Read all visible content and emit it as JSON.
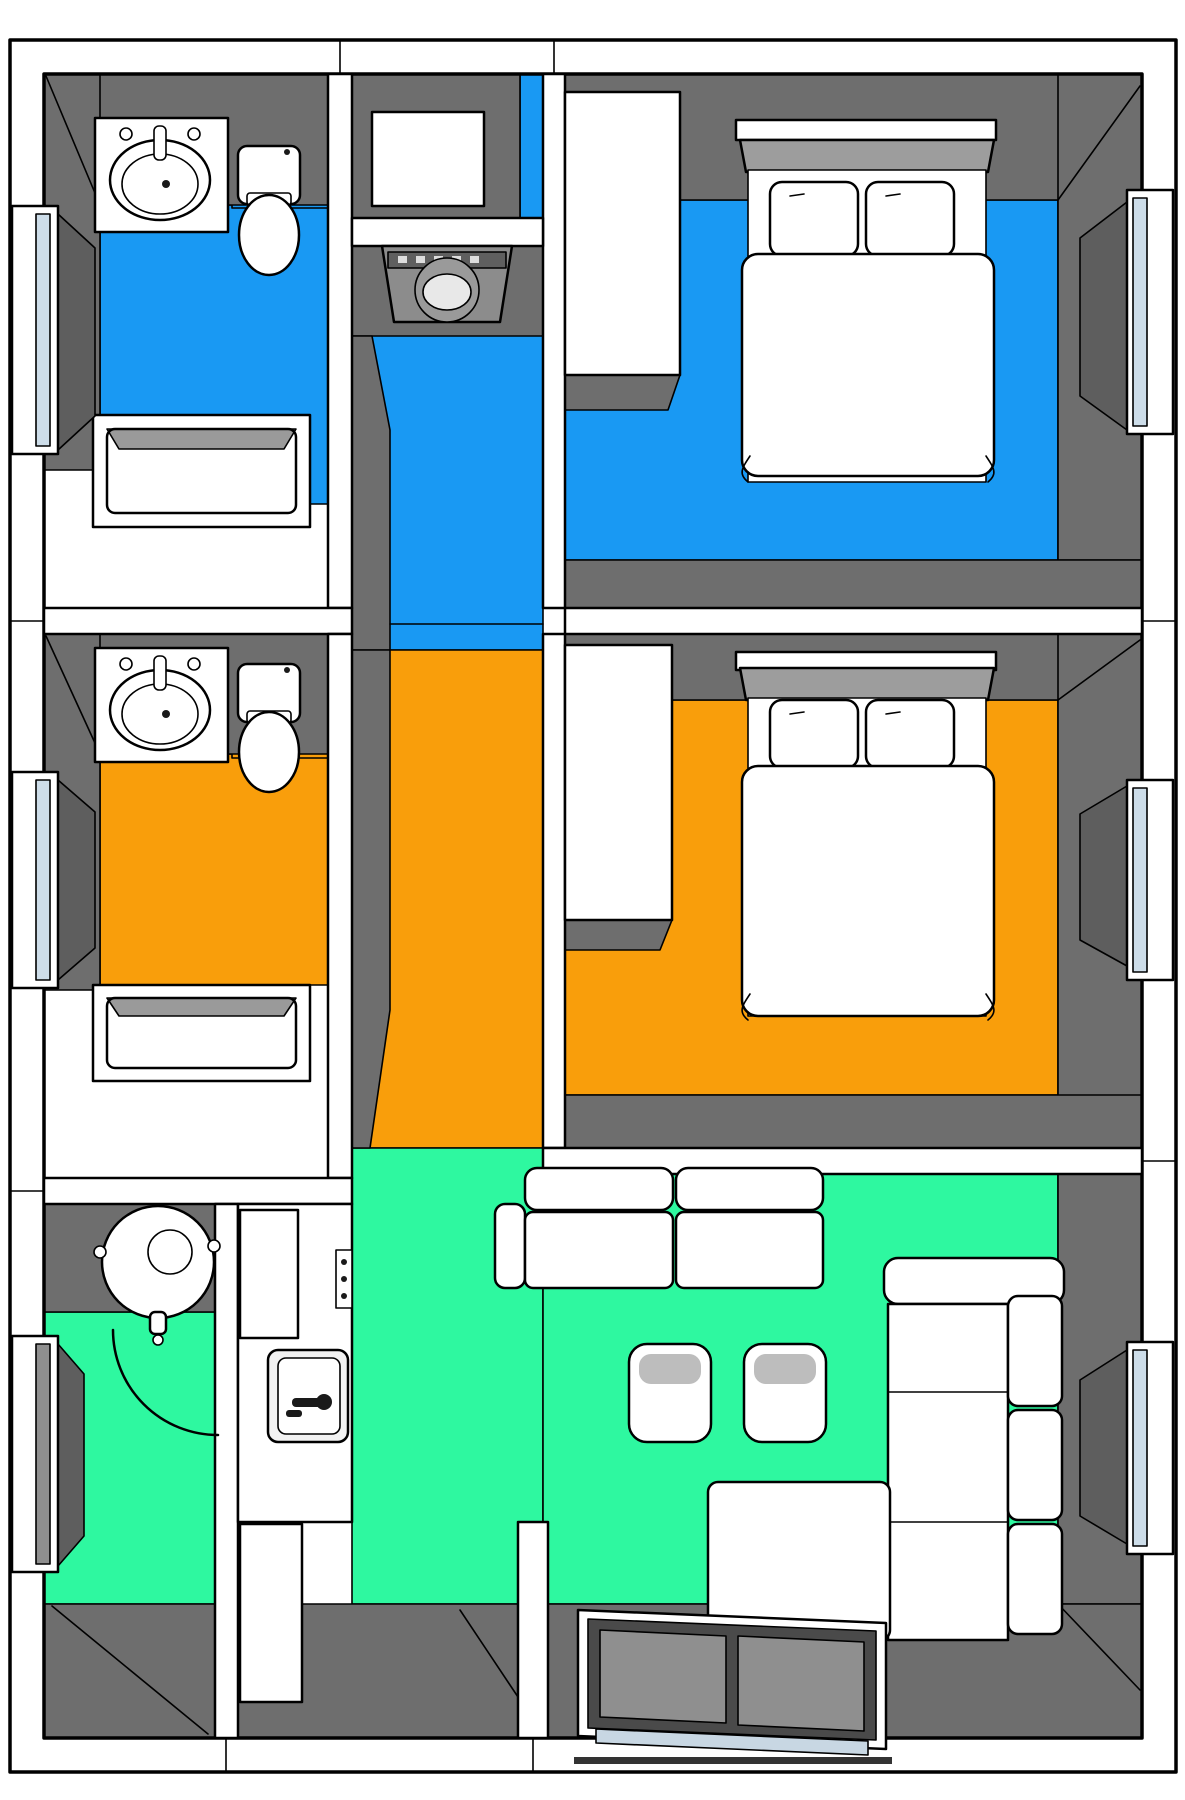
{
  "canvas": {
    "width": 1185,
    "height": 1800
  },
  "colors": {
    "background": "#FFFFFF",
    "wall_white": "#FFFFFF",
    "outline": "#000000",
    "wall_face_gray": "#6E6E6E",
    "reveal_gray": "#5E5E5E",
    "entry_floor_gray": "#6E6E6E",
    "floor_blue": "#1999F3",
    "floor_orange": "#F99E0B",
    "floor_green": "#2EF8A0",
    "glass_light": "#CDDDE9",
    "glass_dark": "#8F8F8F",
    "sill_blue": "#C8D7E3",
    "door_frame": "#4A4A4A",
    "headboard_gray": "#9D9D9D",
    "appliance_gray": "#8C8C8C",
    "appliance_panel": "#5F5F5F",
    "drum_light": "#E8E8E8",
    "drum_mid": "#9A9A9A",
    "tub_shadow": "#9A9A9A",
    "stool_shadow": "#BDBDBD",
    "cabinet_top_gray": "#9A9A9A",
    "sink_steel": "#F2F2F2",
    "fixture_black": "#1A1A1A"
  },
  "zones": [
    {
      "id": "suite-top",
      "label": "blue-suite",
      "floor_color": "#1999F3",
      "rooms": [
        "bathroom-top",
        "corridor-top",
        "bedroom-top"
      ]
    },
    {
      "id": "suite-middle",
      "label": "orange-suite",
      "floor_color": "#F99E0B",
      "rooms": [
        "bathroom-middle",
        "corridor-middle",
        "bedroom-middle"
      ]
    },
    {
      "id": "common",
      "label": "green-common-area",
      "floor_color": "#2EF8A0",
      "rooms": [
        "shower-room",
        "kitchen",
        "living-room",
        "entry"
      ]
    }
  ],
  "furniture": [
    "vanity-sink",
    "toilet",
    "bathtub",
    "storage-cabinet",
    "washing-machine",
    "wardrobe-closet",
    "double-bed",
    "pillow",
    "duvet",
    "round-shower-basin",
    "kitchen-counter",
    "refrigerator",
    "cooktop-knobs",
    "kitchen-sink",
    "base-cabinet",
    "two-seat-sofa",
    "ottoman",
    "corner-sofa",
    "sliding-entry-door",
    "window"
  ]
}
